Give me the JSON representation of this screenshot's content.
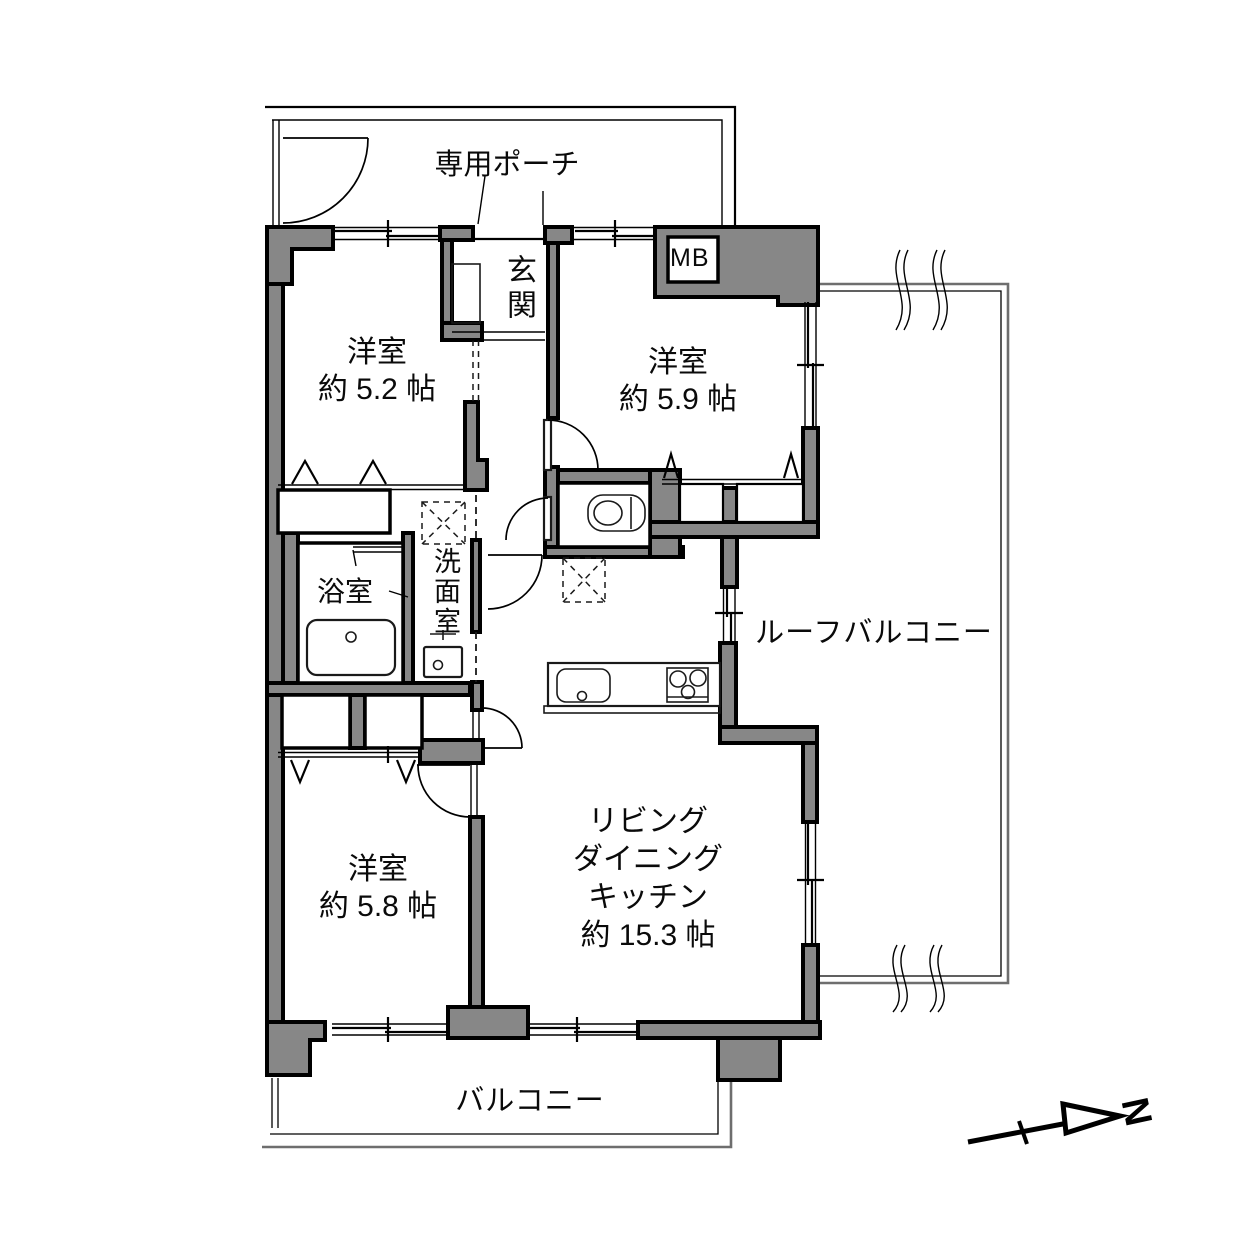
{
  "labels": {
    "porch": "専用ポーチ",
    "entrance": "玄関",
    "meter_box": "MB",
    "bath": "浴室",
    "washroom": "洗面室",
    "roof_balcony": "ルーフバルコニー",
    "balcony": "バルコニー",
    "compass_north": "N"
  },
  "rooms": {
    "bedroom_a": {
      "name": "洋室",
      "size": "約 5.2 帖"
    },
    "bedroom_b": {
      "name": "洋室",
      "size": "約 5.9 帖"
    },
    "bedroom_c": {
      "name": "洋室",
      "size": "約 5.8 帖"
    },
    "ldk": {
      "line1": "リビング",
      "line2": "ダイニング",
      "line3": "キッチン",
      "size": "約 15.3 帖"
    }
  },
  "colors": {
    "wall_fill": "#878787",
    "outline": "#000000",
    "rail": "#6e6e6e",
    "background": "#ffffff"
  }
}
